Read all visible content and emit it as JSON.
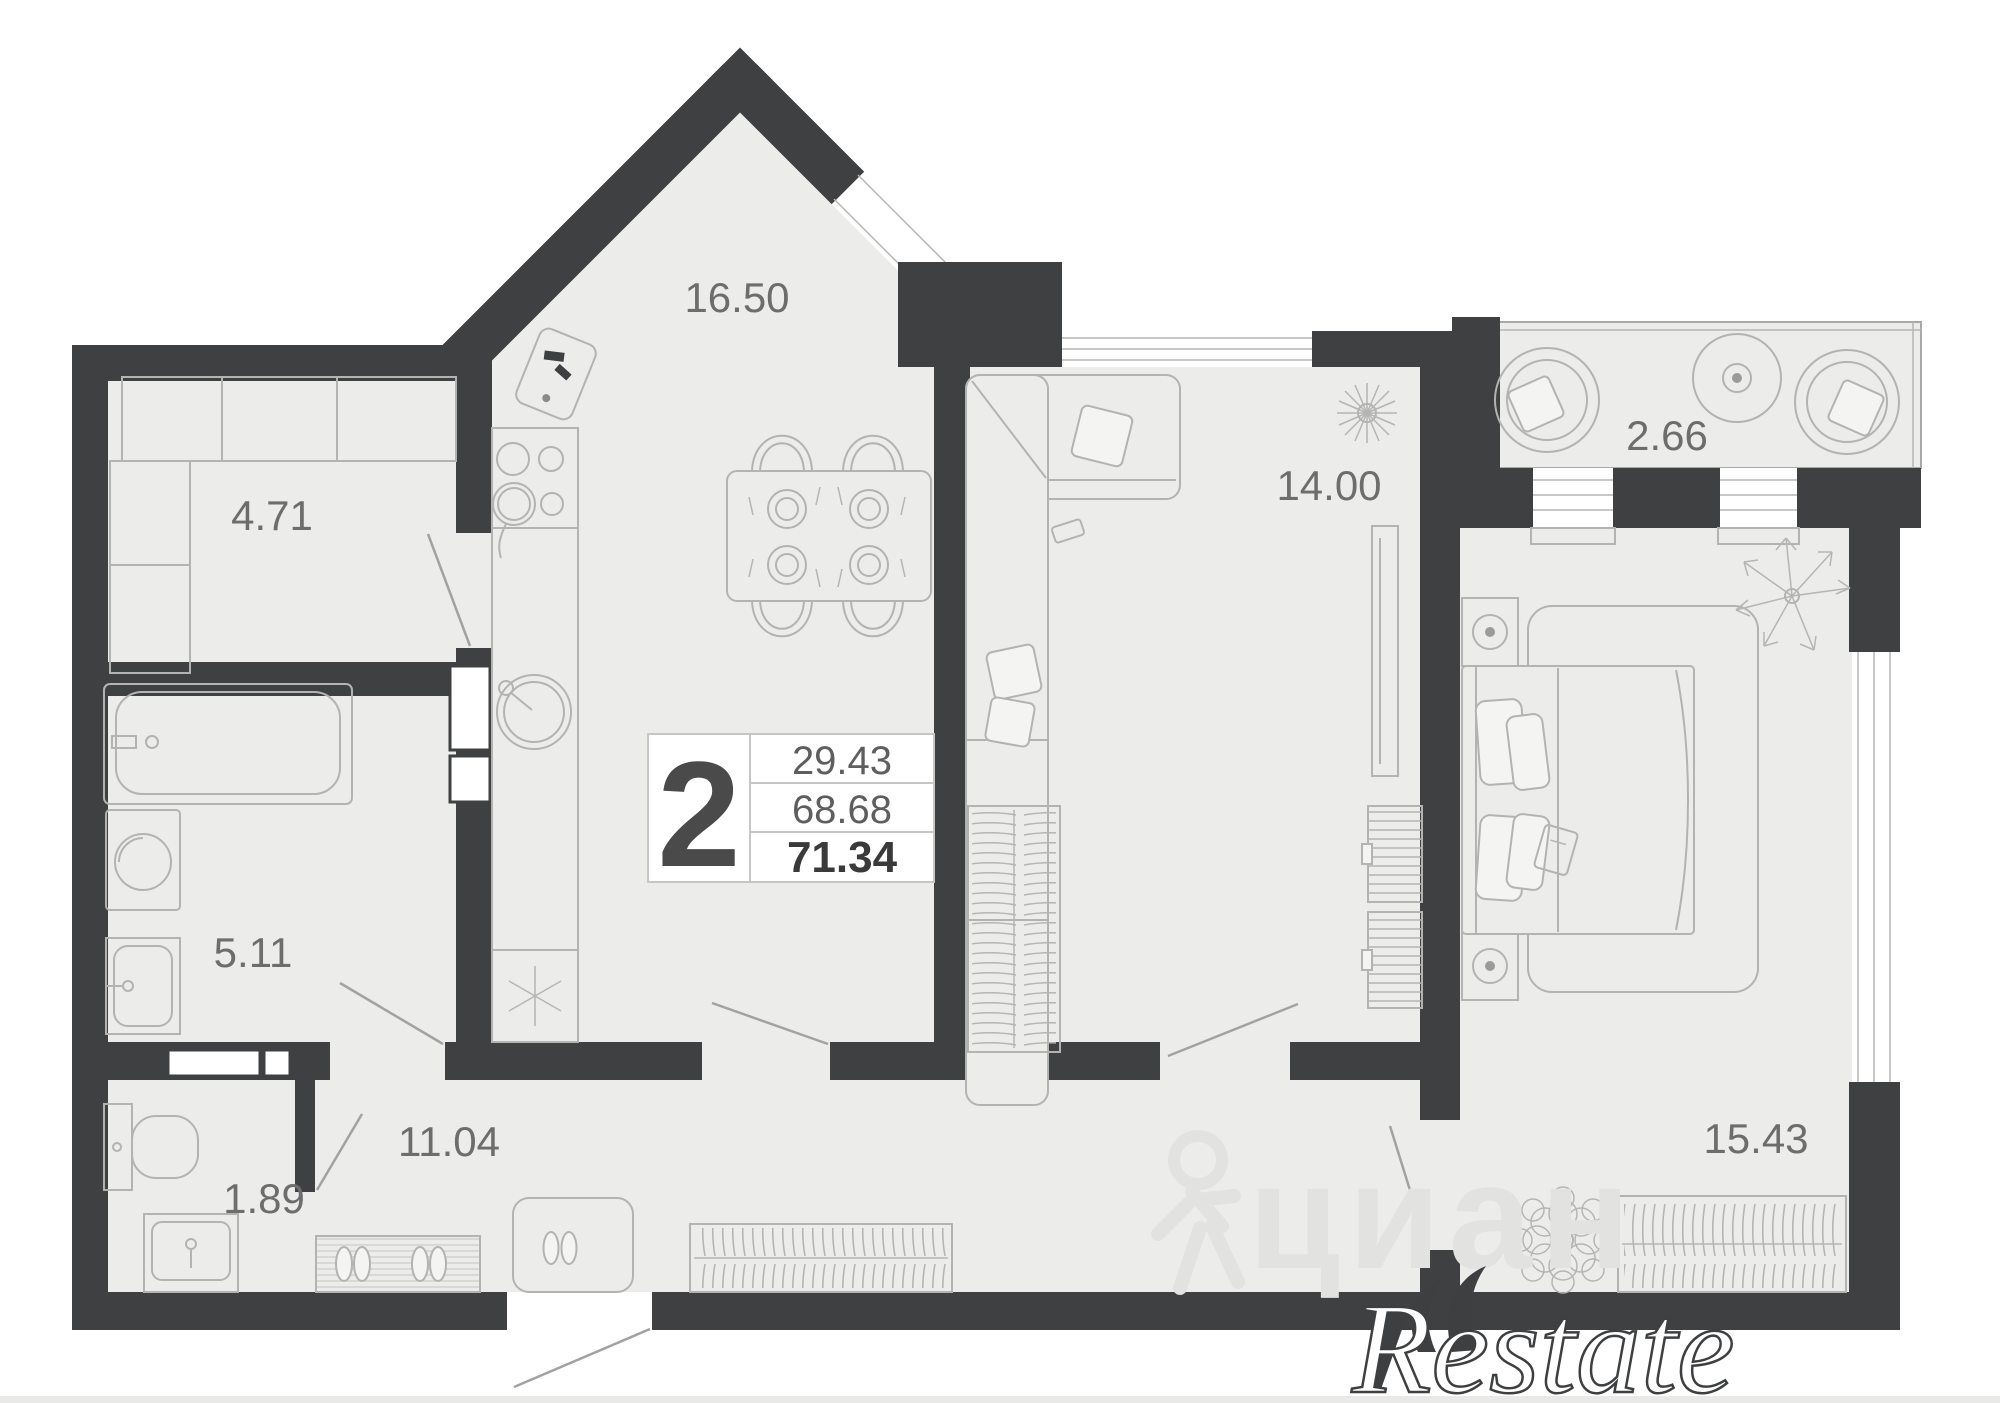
{
  "floorplan": {
    "info_box": {
      "rooms_count": "2",
      "value_top": "29.43",
      "value_middle": "68.68",
      "value_bottom": "71.34"
    },
    "room_labels": {
      "kitchen_living": "16.50",
      "storage": "4.71",
      "bathroom": "5.11",
      "wc": "1.89",
      "hallway": "11.04",
      "living": "14.00",
      "balcony": "2.66",
      "bedroom": "15.43"
    },
    "watermarks": {
      "brand": "Restate",
      "faint": "циан"
    },
    "colors": {
      "wall": "#3E4041",
      "floor": "#ECECEB",
      "furniture_line": "#B3B3B2",
      "label": "#6D6D6D"
    }
  }
}
